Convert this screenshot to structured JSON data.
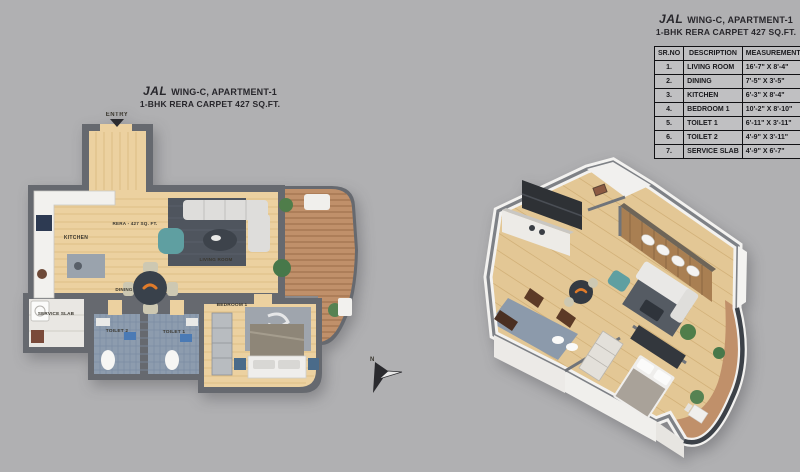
{
  "page": {
    "background_color": "#b0b0b2"
  },
  "plan2d": {
    "title_brand": "JAL",
    "title_rest": "WING-C, APARTMENT-1",
    "subtitle": "1-BHK RERA CARPET 427 SQ.FT.",
    "entry_label": "ENTRY",
    "labels": {
      "kitchen": "KITCHEN",
      "rera": "RERA - 427 SQ. FT.",
      "living_room": "LIVING ROOM",
      "dining": "DINING",
      "service_slab": "SERVICE SLAB",
      "toilet2": "TOILET 2",
      "toilet1": "TOILET 1",
      "bedroom1": "BEDROOM 1"
    },
    "north_label": "N"
  },
  "panel": {
    "title_brand": "JAL",
    "title_rest": "WING-C, APARTMENT-1",
    "subtitle": "1-BHK RERA CARPET 427 SQ.FT.",
    "table": {
      "headers": [
        "SR.NO",
        "DESCRIPTION",
        "MEASUREMENT"
      ],
      "rows": [
        {
          "no": "1.",
          "desc": "LIVING ROOM",
          "meas": "16'-7\" X 8'-4\""
        },
        {
          "no": "2.",
          "desc": "DINING",
          "meas": "7'-5\" X 3'-5\""
        },
        {
          "no": "3.",
          "desc": "KITCHEN",
          "meas": "6'-3\" X 8'-4\""
        },
        {
          "no": "4.",
          "desc": "BEDROOM 1",
          "meas": "10'-2\" X 8'-10\""
        },
        {
          "no": "5.",
          "desc": "TOILET 1",
          "meas": "6'-11\" X 3'-11\""
        },
        {
          "no": "6.",
          "desc": "TOILET 2",
          "meas": "4'-9\" X 3'-11\""
        },
        {
          "no": "7.",
          "desc": "SERVICE SLAB",
          "meas": "4'-9\" X 6'-7\""
        }
      ]
    }
  },
  "colors": {
    "wall_gray": "#66696f",
    "wood_floor": "#ecd1a0",
    "deck_wood": "#c0906a",
    "tile_blue": "#8d9cae",
    "rug_dark": "#4f555e",
    "sofa_light": "#e2e1df",
    "teal_chair": "#5f9fa1",
    "accent_orange": "#e07b2a",
    "text_dark": "#27262b"
  }
}
